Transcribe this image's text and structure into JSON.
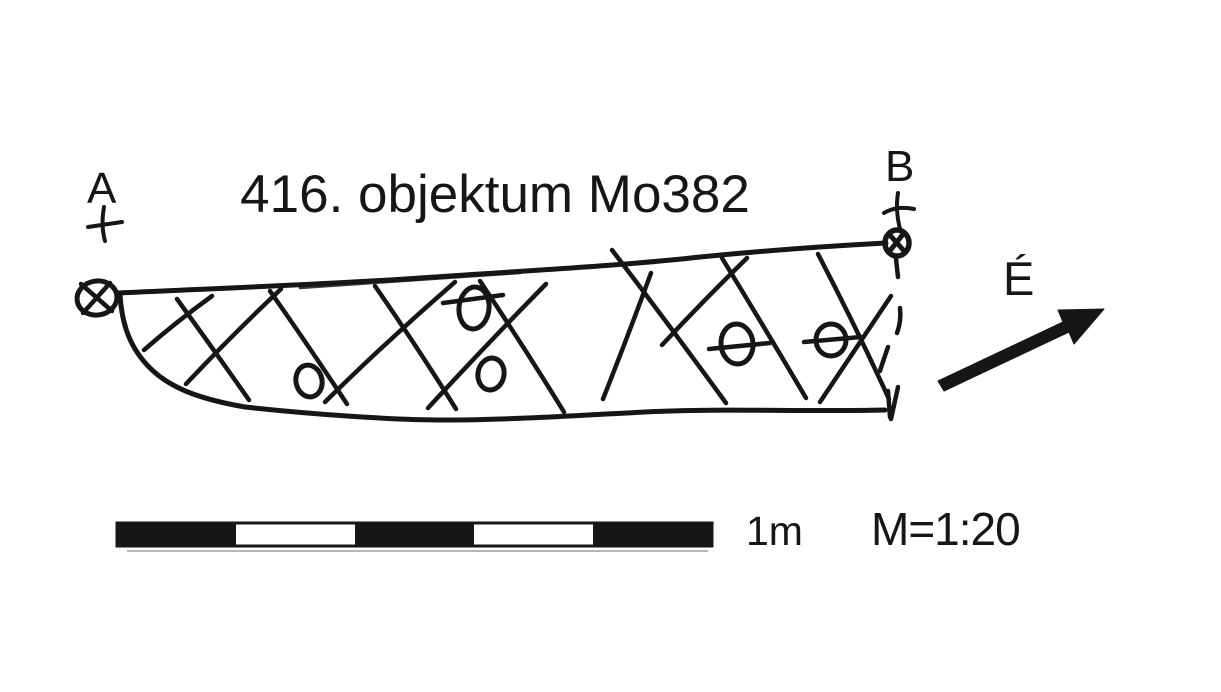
{
  "page": {
    "background_color": "#ffffff",
    "ink_color": "#161616"
  },
  "drawing": {
    "title": "416. objektum Mo382",
    "section_point_a": "A",
    "section_point_b": "B",
    "north_label": "É",
    "scale_length_label": "1m",
    "scale_ratio_label": "M=1:20",
    "scale_bar_segments": 5,
    "stone_marker_count": 5,
    "icons": {
      "datum_a": "crossed-circle",
      "datum_b": "crossed-circle",
      "north": "northeast-arrow",
      "fill_pattern": "cross-hatch"
    }
  }
}
